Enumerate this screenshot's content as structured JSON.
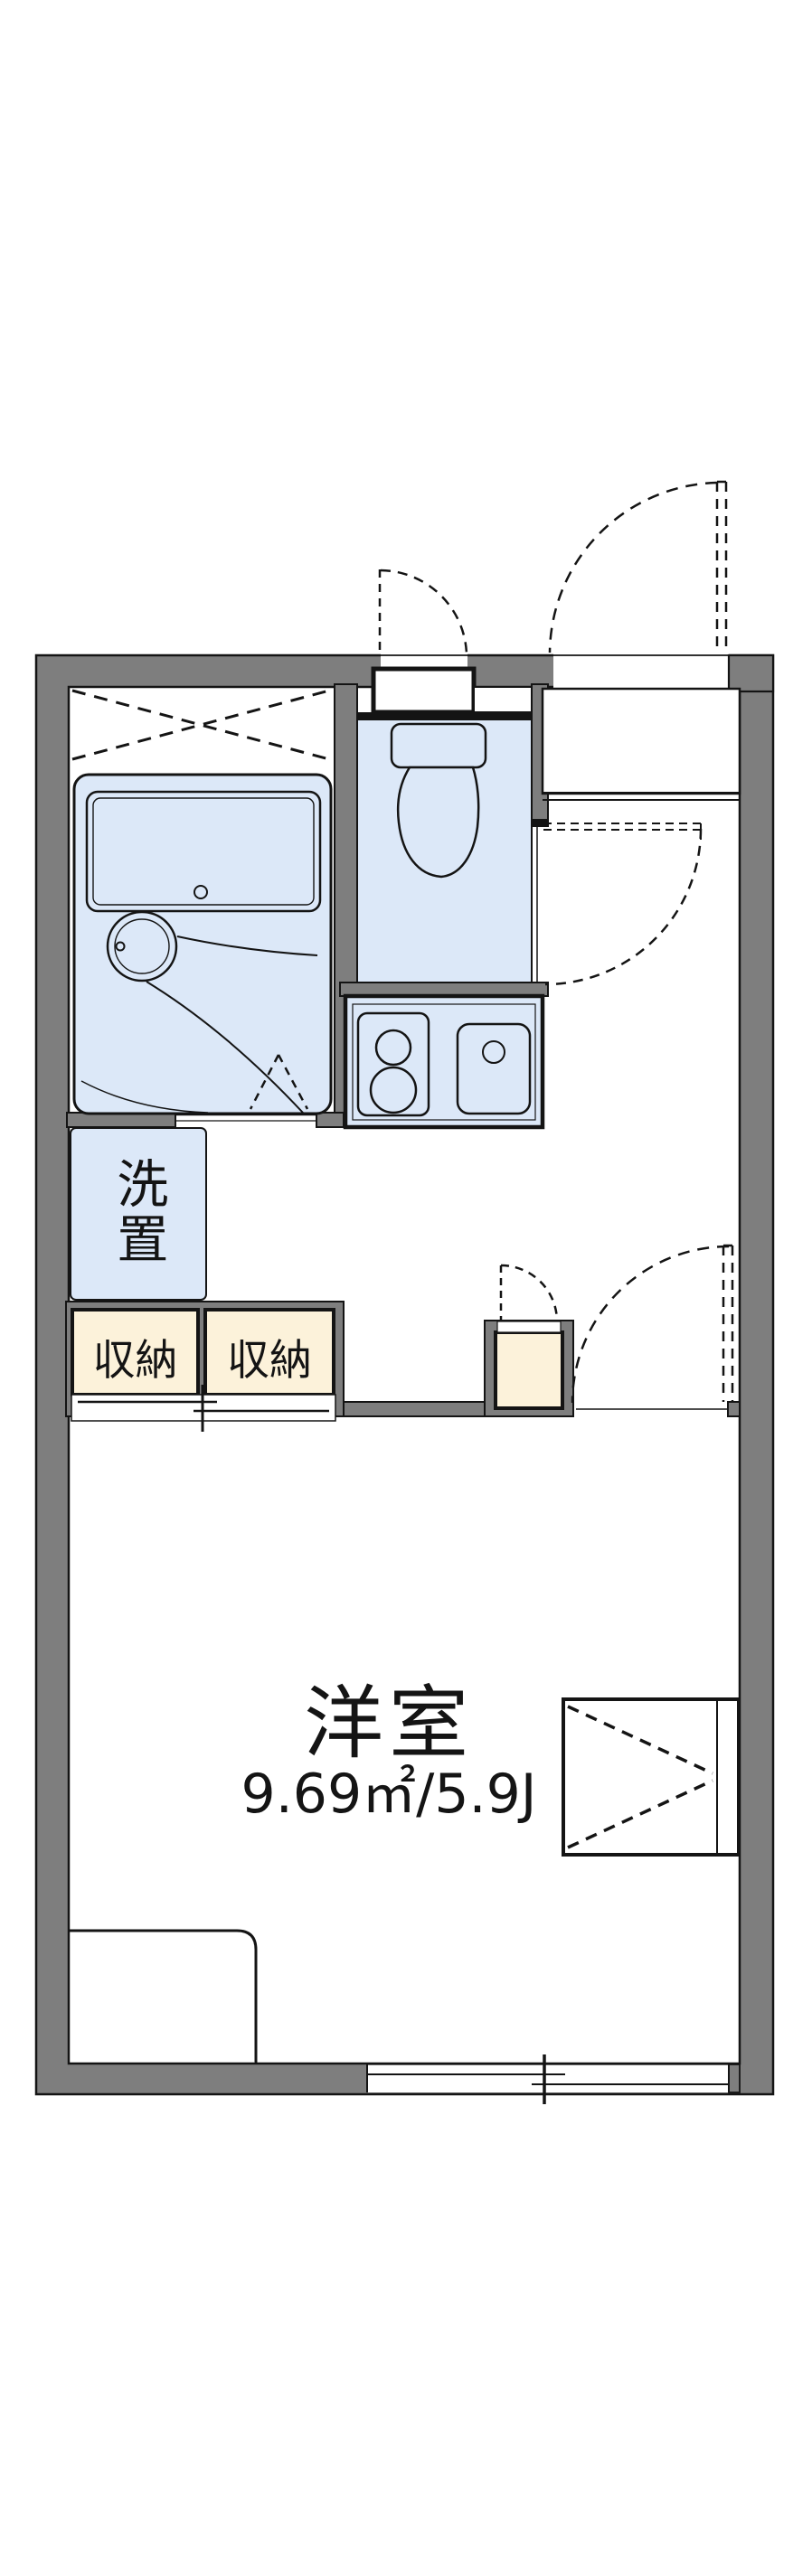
{
  "floorplan": {
    "room": {
      "label": "洋室",
      "area": "9.69㎡/5.9J"
    },
    "laundry": {
      "label": "洗置"
    },
    "storage": [
      {
        "label": "収納"
      },
      {
        "label": "収納"
      }
    ],
    "colors": {
      "wall_gray": "#7e7e7e",
      "water_blue": "#dce8f8",
      "storage_cream": "#fcf2da",
      "line_black": "#141414",
      "background": "#ffffff"
    }
  }
}
